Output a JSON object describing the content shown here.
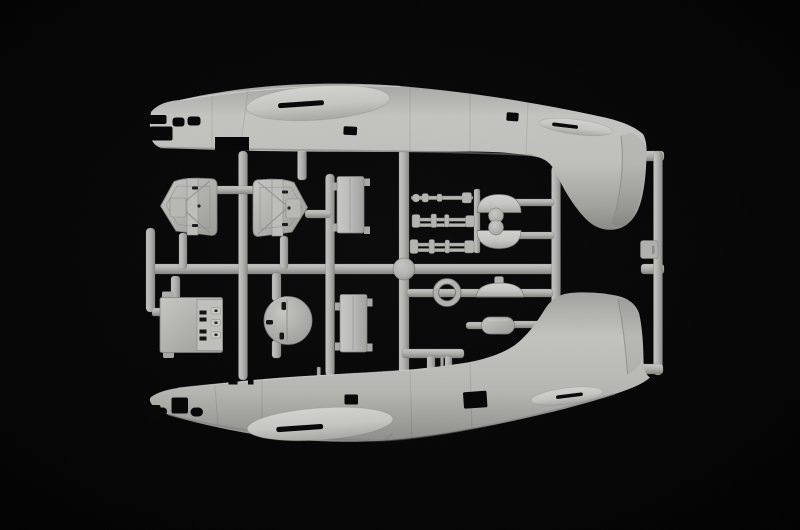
{
  "page": {
    "title": "Model kit sprue photograph"
  },
  "scene": {
    "description": "Studio photograph of a light grey injection-moulded model kit sprue on a black background: two flying-boat fuselage halves (noses left, tail fins facing each other) joined by a grid of runners carrying small detail parts",
    "colors": {
      "background": "#050505",
      "plastic": "#b1b1ae",
      "plastic-light": "#cfcfcc",
      "plastic-dark": "#8b8b88",
      "cutout": "#060606"
    },
    "parts": [
      {
        "id": "fuselage-upper",
        "label": "Upper fuselage half, nose left, tail fin pointing down, oval wing fairing with slot, cabin window cut-outs"
      },
      {
        "id": "fuselage-lower",
        "label": "Lower fuselage half, nose left, tail fin pointing up, oval wing fairing with slot, window cut-outs"
      },
      {
        "id": "float-hull-left",
        "label": "Ribbed float hull half, pointed left"
      },
      {
        "id": "float-hull-right",
        "label": "Ribbed float hull half, pointed right"
      },
      {
        "id": "deck-panel-upper",
        "label": "Rectangular deck panel, upper"
      },
      {
        "id": "deck-panel-lower",
        "label": "Rectangular deck panel, lower"
      },
      {
        "id": "bulkhead-panel",
        "label": "Interior bulkhead panel with slotted detail"
      },
      {
        "id": "bulkhead-disc",
        "label": "Circular bulkhead disc"
      },
      {
        "id": "ring-frame",
        "label": "Ring frame"
      },
      {
        "id": "gun-rods",
        "label": "Three machine-gun / strut rod assemblies"
      },
      {
        "id": "turret-domes",
        "label": "Two turret domes with sighting balls"
      },
      {
        "id": "hatch-dome",
        "label": "Domed hatch with knob"
      },
      {
        "id": "pill-fairing",
        "label": "Pill-shaped fairing"
      },
      {
        "id": "sprue-runners",
        "label": "Grey sprue runners and outer frame rails"
      },
      {
        "id": "sprue-tab",
        "label": "Small moulded tab on right frame rail"
      },
      {
        "id": "runner-boss",
        "label": "Round boss at runner crossing"
      }
    ]
  }
}
